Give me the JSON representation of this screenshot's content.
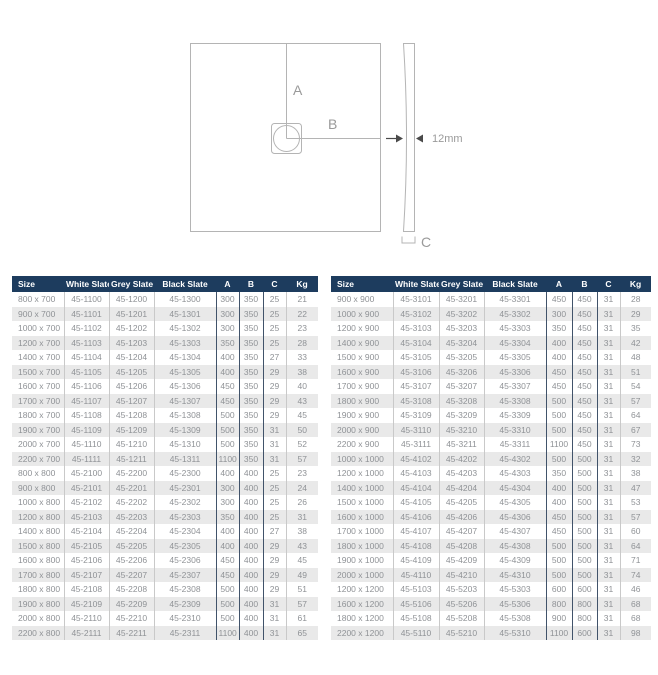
{
  "diagram": {
    "label_a": "A",
    "label_b": "B",
    "label_c": "C",
    "thickness_label": "12mm"
  },
  "colors": {
    "header_bg": "#1d3c5e",
    "header_text": "#ffffff",
    "row_alt_bg": "#e9e9e9",
    "data_text": "#8f9296",
    "border_light": "#c9c9c9",
    "border_dark": "#41536a",
    "diagram_line": "#b4b4b4",
    "diagram_text": "#9a9a9a",
    "arrow_color": "#4a4a4a"
  },
  "tables": [
    {
      "headers": [
        "Size",
        "White Slate",
        "Grey Slate",
        "Black Slate",
        "A",
        "B",
        "C",
        "Kg"
      ],
      "col_widths": [
        52,
        45,
        45,
        62,
        23,
        24,
        23,
        32
      ],
      "rows": [
        [
          "800 x 700",
          "45-1100",
          "45-1200",
          "45-1300",
          "300",
          "350",
          "25",
          "21"
        ],
        [
          "900 x 700",
          "45-1101",
          "45-1201",
          "45-1301",
          "300",
          "350",
          "25",
          "22"
        ],
        [
          "1000 x 700",
          "45-1102",
          "45-1202",
          "45-1302",
          "300",
          "350",
          "25",
          "23"
        ],
        [
          "1200 x 700",
          "45-1103",
          "45-1203",
          "45-1303",
          "350",
          "350",
          "25",
          "28"
        ],
        [
          "1400 x 700",
          "45-1104",
          "45-1204",
          "45-1304",
          "400",
          "350",
          "27",
          "33"
        ],
        [
          "1500 x 700",
          "45-1105",
          "45-1205",
          "45-1305",
          "400",
          "350",
          "29",
          "38"
        ],
        [
          "1600 x 700",
          "45-1106",
          "45-1206",
          "45-1306",
          "450",
          "350",
          "29",
          "40"
        ],
        [
          "1700 x 700",
          "45-1107",
          "45-1207",
          "45-1307",
          "450",
          "350",
          "29",
          "43"
        ],
        [
          "1800 x 700",
          "45-1108",
          "45-1208",
          "45-1308",
          "500",
          "350",
          "29",
          "45"
        ],
        [
          "1900 x 700",
          "45-1109",
          "45-1209",
          "45-1309",
          "500",
          "350",
          "31",
          "50"
        ],
        [
          "2000 x 700",
          "45-1110",
          "45-1210",
          "45-1310",
          "500",
          "350",
          "31",
          "52"
        ],
        [
          "2200 x 700",
          "45-1111",
          "45-1211",
          "45-1311",
          "1100",
          "350",
          "31",
          "57"
        ],
        [
          "800 x 800",
          "45-2100",
          "45-2200",
          "45-2300",
          "400",
          "400",
          "25",
          "23"
        ],
        [
          "900 x 800",
          "45-2101",
          "45-2201",
          "45-2301",
          "300",
          "400",
          "25",
          "24"
        ],
        [
          "1000 x 800",
          "45-2102",
          "45-2202",
          "45-2302",
          "300",
          "400",
          "25",
          "26"
        ],
        [
          "1200 x 800",
          "45-2103",
          "45-2203",
          "45-2303",
          "350",
          "400",
          "25",
          "31"
        ],
        [
          "1400 x 800",
          "45-2104",
          "45-2204",
          "45-2304",
          "400",
          "400",
          "27",
          "38"
        ],
        [
          "1500 x 800",
          "45-2105",
          "45-2205",
          "45-2305",
          "400",
          "400",
          "29",
          "43"
        ],
        [
          "1600 x 800",
          "45-2106",
          "45-2206",
          "45-2306",
          "450",
          "400",
          "29",
          "45"
        ],
        [
          "1700 x 800",
          "45-2107",
          "45-2207",
          "45-2307",
          "450",
          "400",
          "29",
          "49"
        ],
        [
          "1800 x 800",
          "45-2108",
          "45-2208",
          "45-2308",
          "500",
          "400",
          "29",
          "51"
        ],
        [
          "1900 x 800",
          "45-2109",
          "45-2209",
          "45-2309",
          "500",
          "400",
          "31",
          "57"
        ],
        [
          "2000 x 800",
          "45-2110",
          "45-2210",
          "45-2310",
          "500",
          "400",
          "31",
          "61"
        ],
        [
          "2200 x 800",
          "45-2111",
          "45-2211",
          "45-2311",
          "1100",
          "400",
          "31",
          "65"
        ]
      ]
    },
    {
      "headers": [
        "Size",
        "White Slate",
        "Grey Slate",
        "Black Slate",
        "A",
        "B",
        "C",
        "Kg"
      ],
      "col_widths": [
        62,
        46,
        45,
        62,
        26,
        25,
        23,
        31
      ],
      "rows": [
        [
          "900 x 900",
          "45-3101",
          "45-3201",
          "45-3301",
          "450",
          "450",
          "31",
          "28"
        ],
        [
          "1000 x 900",
          "45-3102",
          "45-3202",
          "45-3302",
          "300",
          "450",
          "31",
          "29"
        ],
        [
          "1200 x 900",
          "45-3103",
          "45-3203",
          "45-3303",
          "350",
          "450",
          "31",
          "35"
        ],
        [
          "1400 x 900",
          "45-3104",
          "45-3204",
          "45-3304",
          "400",
          "450",
          "31",
          "42"
        ],
        [
          "1500 x 900",
          "45-3105",
          "45-3205",
          "45-3305",
          "400",
          "450",
          "31",
          "48"
        ],
        [
          "1600 x 900",
          "45-3106",
          "45-3206",
          "45-3306",
          "450",
          "450",
          "31",
          "51"
        ],
        [
          "1700 x 900",
          "45-3107",
          "45-3207",
          "45-3307",
          "450",
          "450",
          "31",
          "54"
        ],
        [
          "1800 x 900",
          "45-3108",
          "45-3208",
          "45-3308",
          "500",
          "450",
          "31",
          "57"
        ],
        [
          "1900 x 900",
          "45-3109",
          "45-3209",
          "45-3309",
          "500",
          "450",
          "31",
          "64"
        ],
        [
          "2000 x 900",
          "45-3110",
          "45-3210",
          "45-3310",
          "500",
          "450",
          "31",
          "67"
        ],
        [
          "2200 x 900",
          "45-3111",
          "45-3211",
          "45-3311",
          "1100",
          "450",
          "31",
          "73"
        ],
        [
          "1000 x 1000",
          "45-4102",
          "45-4202",
          "45-4302",
          "500",
          "500",
          "31",
          "32"
        ],
        [
          "1200 x 1000",
          "45-4103",
          "45-4203",
          "45-4303",
          "350",
          "500",
          "31",
          "38"
        ],
        [
          "1400 x 1000",
          "45-4104",
          "45-4204",
          "45-4304",
          "400",
          "500",
          "31",
          "47"
        ],
        [
          "1500 x 1000",
          "45-4105",
          "45-4205",
          "45-4305",
          "400",
          "500",
          "31",
          "53"
        ],
        [
          "1600 x 1000",
          "45-4106",
          "45-4206",
          "45-4306",
          "450",
          "500",
          "31",
          "57"
        ],
        [
          "1700 x 1000",
          "45-4107",
          "45-4207",
          "45-4307",
          "450",
          "500",
          "31",
          "60"
        ],
        [
          "1800 x 1000",
          "45-4108",
          "45-4208",
          "45-4308",
          "500",
          "500",
          "31",
          "64"
        ],
        [
          "1900 x 1000",
          "45-4109",
          "45-4209",
          "45-4309",
          "500",
          "500",
          "31",
          "71"
        ],
        [
          "2000 x 1000",
          "45-4110",
          "45-4210",
          "45-4310",
          "500",
          "500",
          "31",
          "74"
        ],
        [
          "1200 x 1200",
          "45-5103",
          "45-5203",
          "45-5303",
          "600",
          "600",
          "31",
          "46"
        ],
        [
          "1600 x 1200",
          "45-5106",
          "45-5206",
          "45-5306",
          "800",
          "800",
          "31",
          "68"
        ],
        [
          "1800 x 1200",
          "45-5108",
          "45-5208",
          "45-5308",
          "900",
          "800",
          "31",
          "68"
        ],
        [
          "2200 x 1200",
          "45-5110",
          "45-5210",
          "45-5310",
          "1100",
          "600",
          "31",
          "98"
        ]
      ]
    }
  ]
}
